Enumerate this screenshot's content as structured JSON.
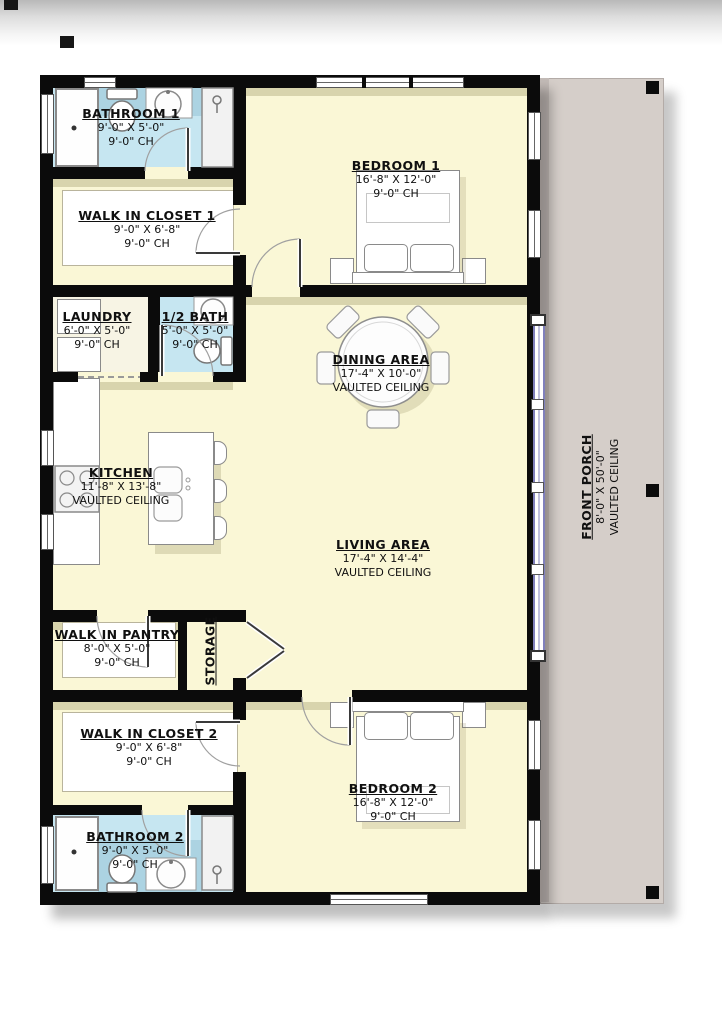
{
  "rooms": {
    "bathroom1": {
      "name": "BATHROOM 1",
      "dims": "9'-0\" X 5'-0\"",
      "ceiling": "9'-0\" CH"
    },
    "closet1": {
      "name": "WALK IN CLOSET 1",
      "dims": "9'-0\" X 6'-8\"",
      "ceiling": "9'-0\" CH"
    },
    "laundry": {
      "name": "LAUNDRY",
      "dims": "6'-0\" X 5'-0\"",
      "ceiling": "9'-0\" CH"
    },
    "halfbath": {
      "name": "1/2 BATH",
      "dims": "5'-0\" X 5'-0\"",
      "ceiling": "9'-0\" CH"
    },
    "bedroom1": {
      "name": "BEDROOM 1",
      "dims": "16'-8\" X 12'-0\"",
      "ceiling": "9'-0\" CH"
    },
    "dining": {
      "name": "DINING AREA",
      "dims": "17'-4\" X 10'-0\"",
      "ceiling": "VAULTED CEILING"
    },
    "kitchen": {
      "name": "KITCHEN",
      "dims": "11'-8\" X 13'-8\"",
      "ceiling": "VAULTED CEILING"
    },
    "living": {
      "name": "LIVING AREA",
      "dims": "17'-4\" X 14'-4\"",
      "ceiling": "VAULTED CEILING"
    },
    "pantry": {
      "name": "WALK IN PANTRY",
      "dims": "8'-0\" X 5'-0\"",
      "ceiling": "9'-0\" CH"
    },
    "storage": {
      "name": "STORAGE"
    },
    "closet2": {
      "name": "WALK IN CLOSET 2",
      "dims": "9'-0\" X 6'-8\"",
      "ceiling": "9'-0\" CH"
    },
    "bedroom2": {
      "name": "BEDROOM 2",
      "dims": "16'-8\" X 12'-0\"",
      "ceiling": "9'-0\" CH"
    },
    "bathroom2": {
      "name": "BATHROOM 2",
      "dims": "9'-0\" X 5'-0\"",
      "ceiling": "9'-0\" CH"
    },
    "porch": {
      "name": "FRONT PORCH",
      "dims": "8'-0\" X 50'-0\"",
      "ceiling": "VAULTED CEILING"
    }
  },
  "colors": {
    "wall": "#0b0b0b",
    "floor": "#faf7d6",
    "bathroom_floor": "#c6e6f1",
    "bathroom_accent": "#a3ccdc",
    "porch": "#d5cec9",
    "glass_wall": "#8080bc"
  }
}
